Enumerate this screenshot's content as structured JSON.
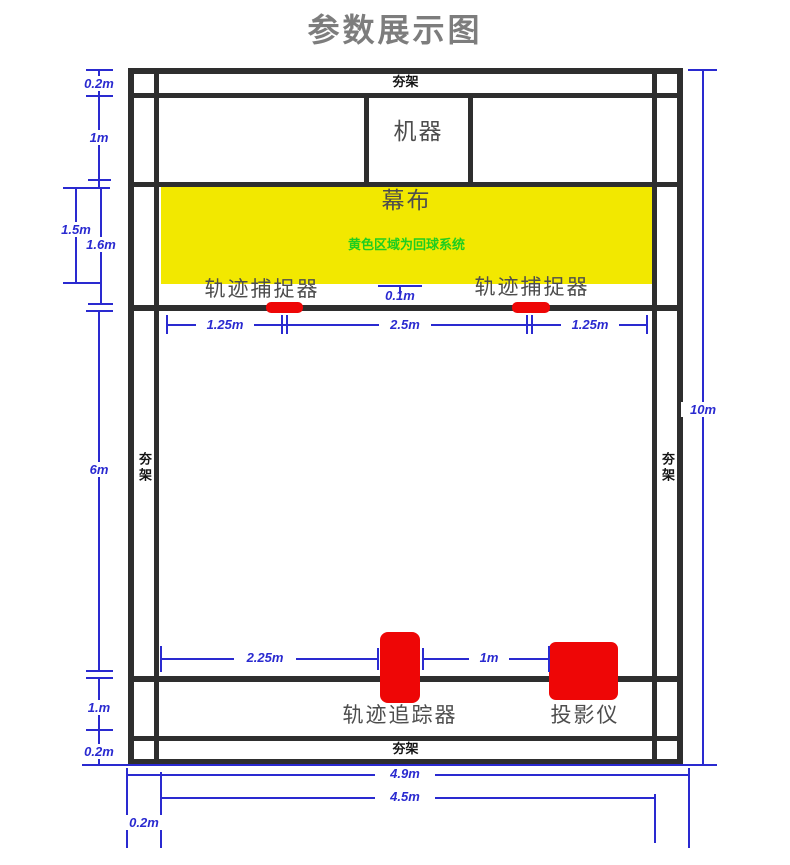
{
  "title": "参数展示图",
  "colors": {
    "frame": "#2e2e2e",
    "blue": "#2a2ad0",
    "yellow": "#f2e800",
    "green": "#1fce1f",
    "red": "#ee0606",
    "label": "#4d4d4d",
    "title": "#7d7d7d"
  },
  "frame": {
    "truss_top": "夯架",
    "truss_bottom": "夯架",
    "truss_left": "夯架",
    "truss_right": "夯架"
  },
  "devices": {
    "machine": "机器",
    "screen": "幕布",
    "screen_note": "黄色区域为回球系统",
    "capture_left": "轨迹捕捉器",
    "capture_right": "轨迹捕捉器",
    "tracker": "轨迹追踪器",
    "projector": "投影仪"
  },
  "dims": {
    "top_offset": "0.2m",
    "machine_row_height": "1m",
    "screen_height": "1.5m",
    "screen_to_net": "1.6m",
    "screen_net_gap": "0.1m",
    "net_left": "1.25m",
    "net_center": "2.5m",
    "net_right": "1.25m",
    "court_height": "6m",
    "total_height": "10m",
    "tracker_offset": "2.25m",
    "tracker_projector_gap": "1m",
    "bottom_row_height": "1.m",
    "bottom_offset": "0.2m",
    "outer_width": "4.9m",
    "inner_width": "4.5m",
    "width_offset": "0.2m"
  }
}
